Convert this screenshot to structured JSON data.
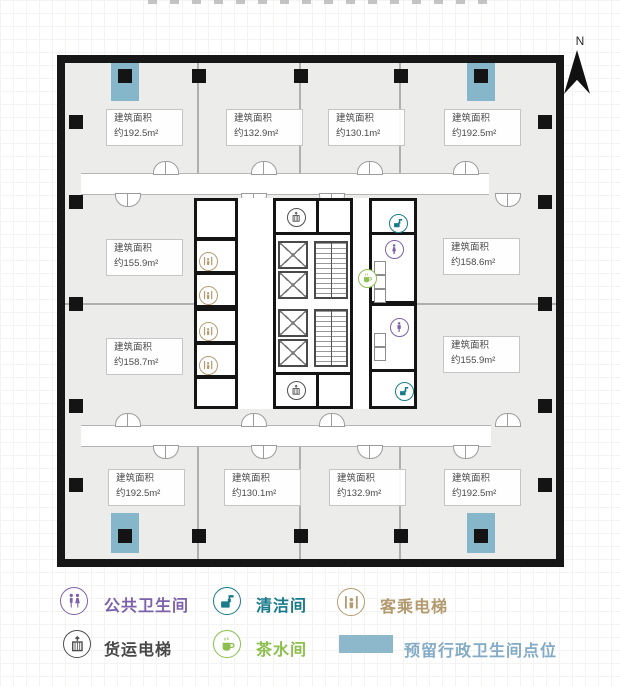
{
  "north": {
    "label": "N"
  },
  "plan": {
    "area_prefix": "建筑面积",
    "rooms": [
      {
        "area": "约192.5m²"
      },
      {
        "area": "约132.9m²"
      },
      {
        "area": "约130.1m²"
      },
      {
        "area": "约192.5m²"
      },
      {
        "area": "约155.9m²"
      },
      {
        "area": "约158.7m²"
      },
      {
        "area": "约158.6m²"
      },
      {
        "area": "约155.9m²"
      },
      {
        "area": "约192.5m²"
      },
      {
        "area": "约130.1m²"
      },
      {
        "area": "约132.9m²"
      },
      {
        "area": "约192.5m²"
      }
    ],
    "colors": {
      "reserved_blue": "#86b6ca",
      "wall": "#171717",
      "floor": "#ecedeb"
    }
  },
  "legend": {
    "items": [
      {
        "icon": "public-restroom-icon",
        "label": "公共卫生间",
        "color": "#7d62ab"
      },
      {
        "icon": "cleaning-room-icon",
        "label": "清洁间",
        "color": "#17798a"
      },
      {
        "icon": "passenger-elevator-icon",
        "label": "客乘电梯",
        "color": "#b39a6e"
      },
      {
        "icon": "freight-elevator-icon",
        "label": "货运电梯",
        "color": "#474747"
      },
      {
        "icon": "tea-room-icon",
        "label": "茶水间",
        "color": "#8cbf4d"
      },
      {
        "icon": "reserved-restroom-swatch",
        "label": "预留行政卫生间点位",
        "color": "#83abc6",
        "swatch_color": "#8db8cc"
      }
    ]
  }
}
